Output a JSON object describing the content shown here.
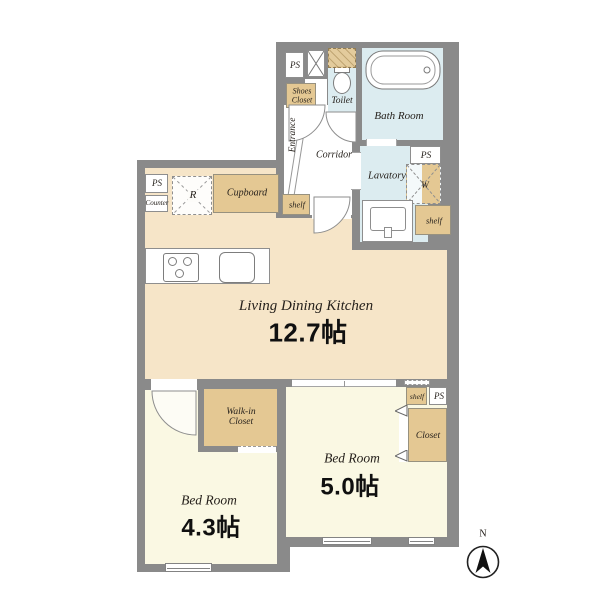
{
  "rooms": {
    "ldk": {
      "name": "Living Dining Kitchen",
      "size": "12.7帖"
    },
    "bedroom_south": {
      "name": "Bed Room",
      "size": "5.0帖"
    },
    "bedroom_west": {
      "name": "Bed Room",
      "size": "4.3帖"
    },
    "bath": "Bath Room",
    "lavatory": "Lavatory",
    "toilet": "Toilet",
    "corridor": "Corridor",
    "entrance": "Entrance"
  },
  "storage": {
    "shoes_closet": "Shoes Closet",
    "cupboard": "Cupboard",
    "walk_in_closet": "Walk-in Closet",
    "closet": "Closet",
    "shelf": "shelf"
  },
  "fixtures": {
    "ps": "PS",
    "counter": "Counter",
    "refrigerator": "R",
    "washer": "W"
  },
  "compass": {
    "north": "N"
  },
  "colors": {
    "wall": "#8a8a8a",
    "ldk_floor": "#f6e5c8",
    "bedroom_floor": "#faf8e3",
    "wet_floor": "#dcecf0",
    "storage_fill": "#e4c893",
    "background": "#ffffff"
  }
}
